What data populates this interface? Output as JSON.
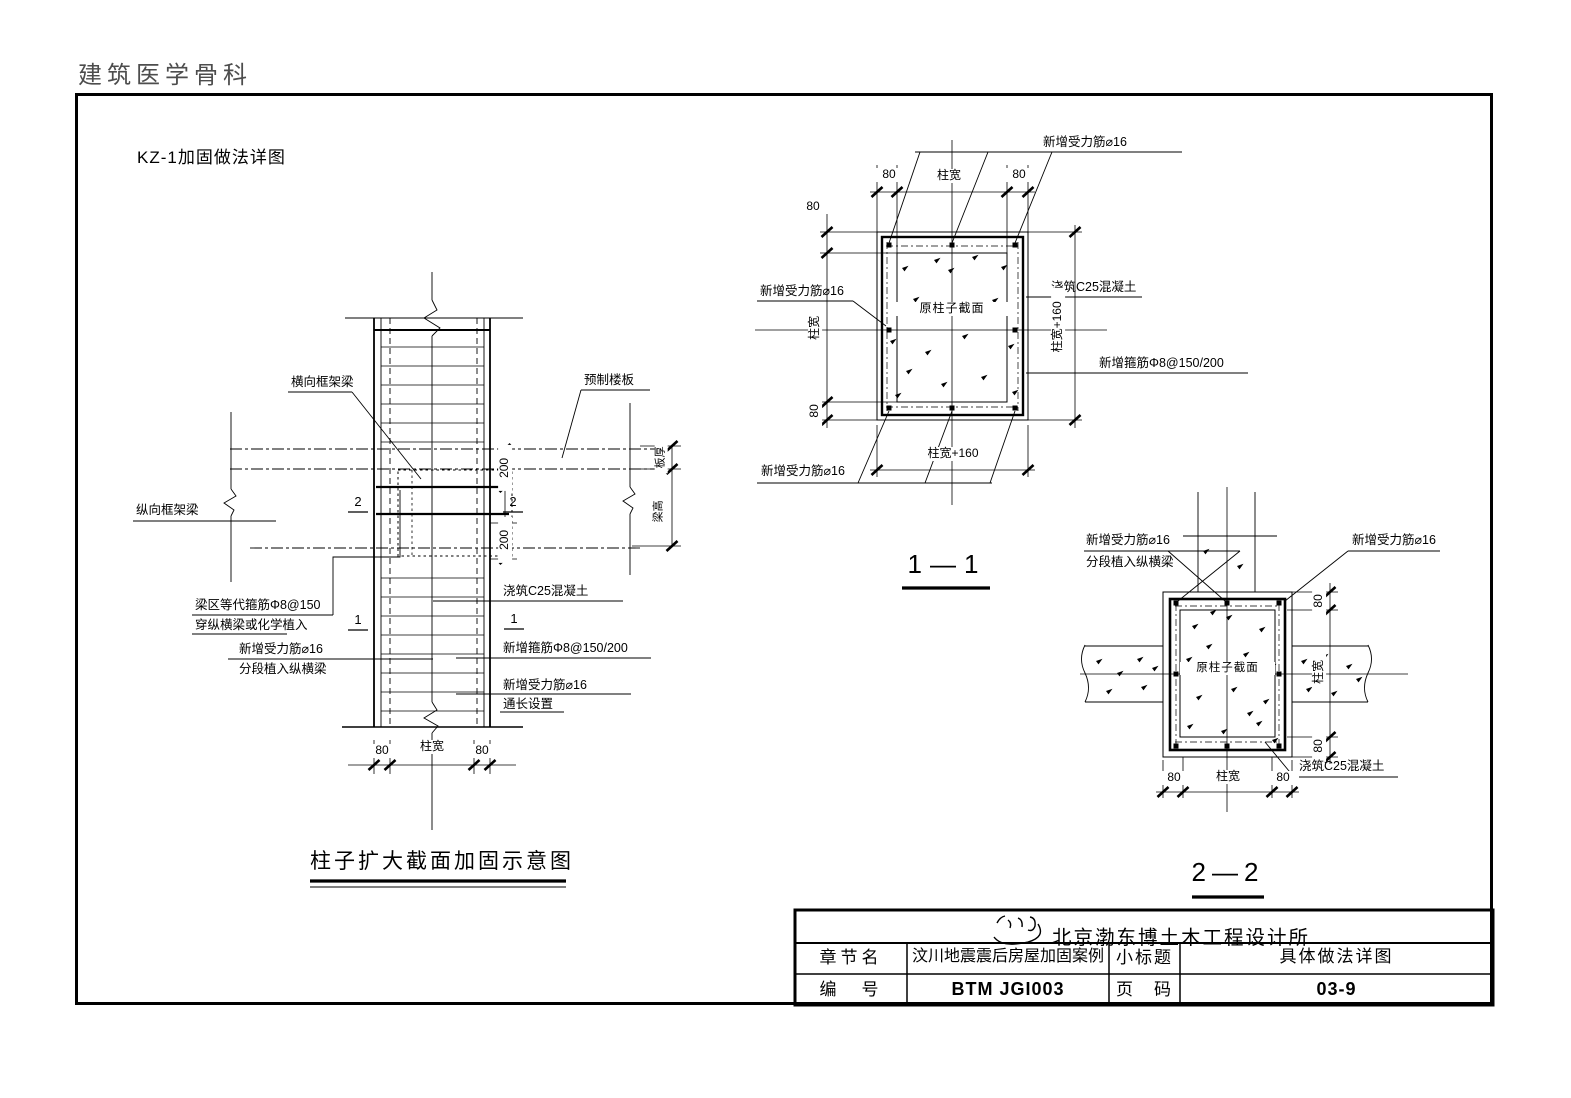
{
  "page": {
    "watermark": "建筑医学骨科",
    "title": "KZ-1加固做法详图"
  },
  "common": {
    "new_rebar": "新增受力筋⌀16",
    "implant_beams": "分段植入纵横梁",
    "cast_concrete": "浇筑C25混凝土",
    "new_stirrup": "新增箍筋Φ8@150/200",
    "col_width": "柱宽",
    "d80": "80",
    "col_width_plus160": "柱宽+160",
    "core_section": "原柱子截面"
  },
  "elevation": {
    "caption": "柱子扩大截面加固示意图",
    "transverse_beam": "横向框架梁",
    "precast_slab": "预制楼板",
    "longitudinal_beam": "纵向框架梁",
    "equiv_stirrup_l1": "梁区等代箍筋Φ8@150",
    "equiv_stirrup_l2": "穿纵横梁或化学植入",
    "full_length": "通长设置",
    "d200": "200",
    "slab_thickness": "板厚",
    "beam_height": "梁高",
    "mark_1": "1",
    "mark_2": "2"
  },
  "sections": {
    "s11_title": "1—1",
    "s22_title": "2—2"
  },
  "title_block": {
    "company": "北京渤东博土木工程设计所",
    "chapter_label": "章节名",
    "chapter_value": "汶川地震震后房屋加固案例",
    "subtitle_label": "小标题",
    "subtitle_value": "具体做法详图",
    "number_label": "编　号",
    "number_value": "BTM JGI003",
    "page_label": "页　码",
    "page_value": "03-9"
  }
}
